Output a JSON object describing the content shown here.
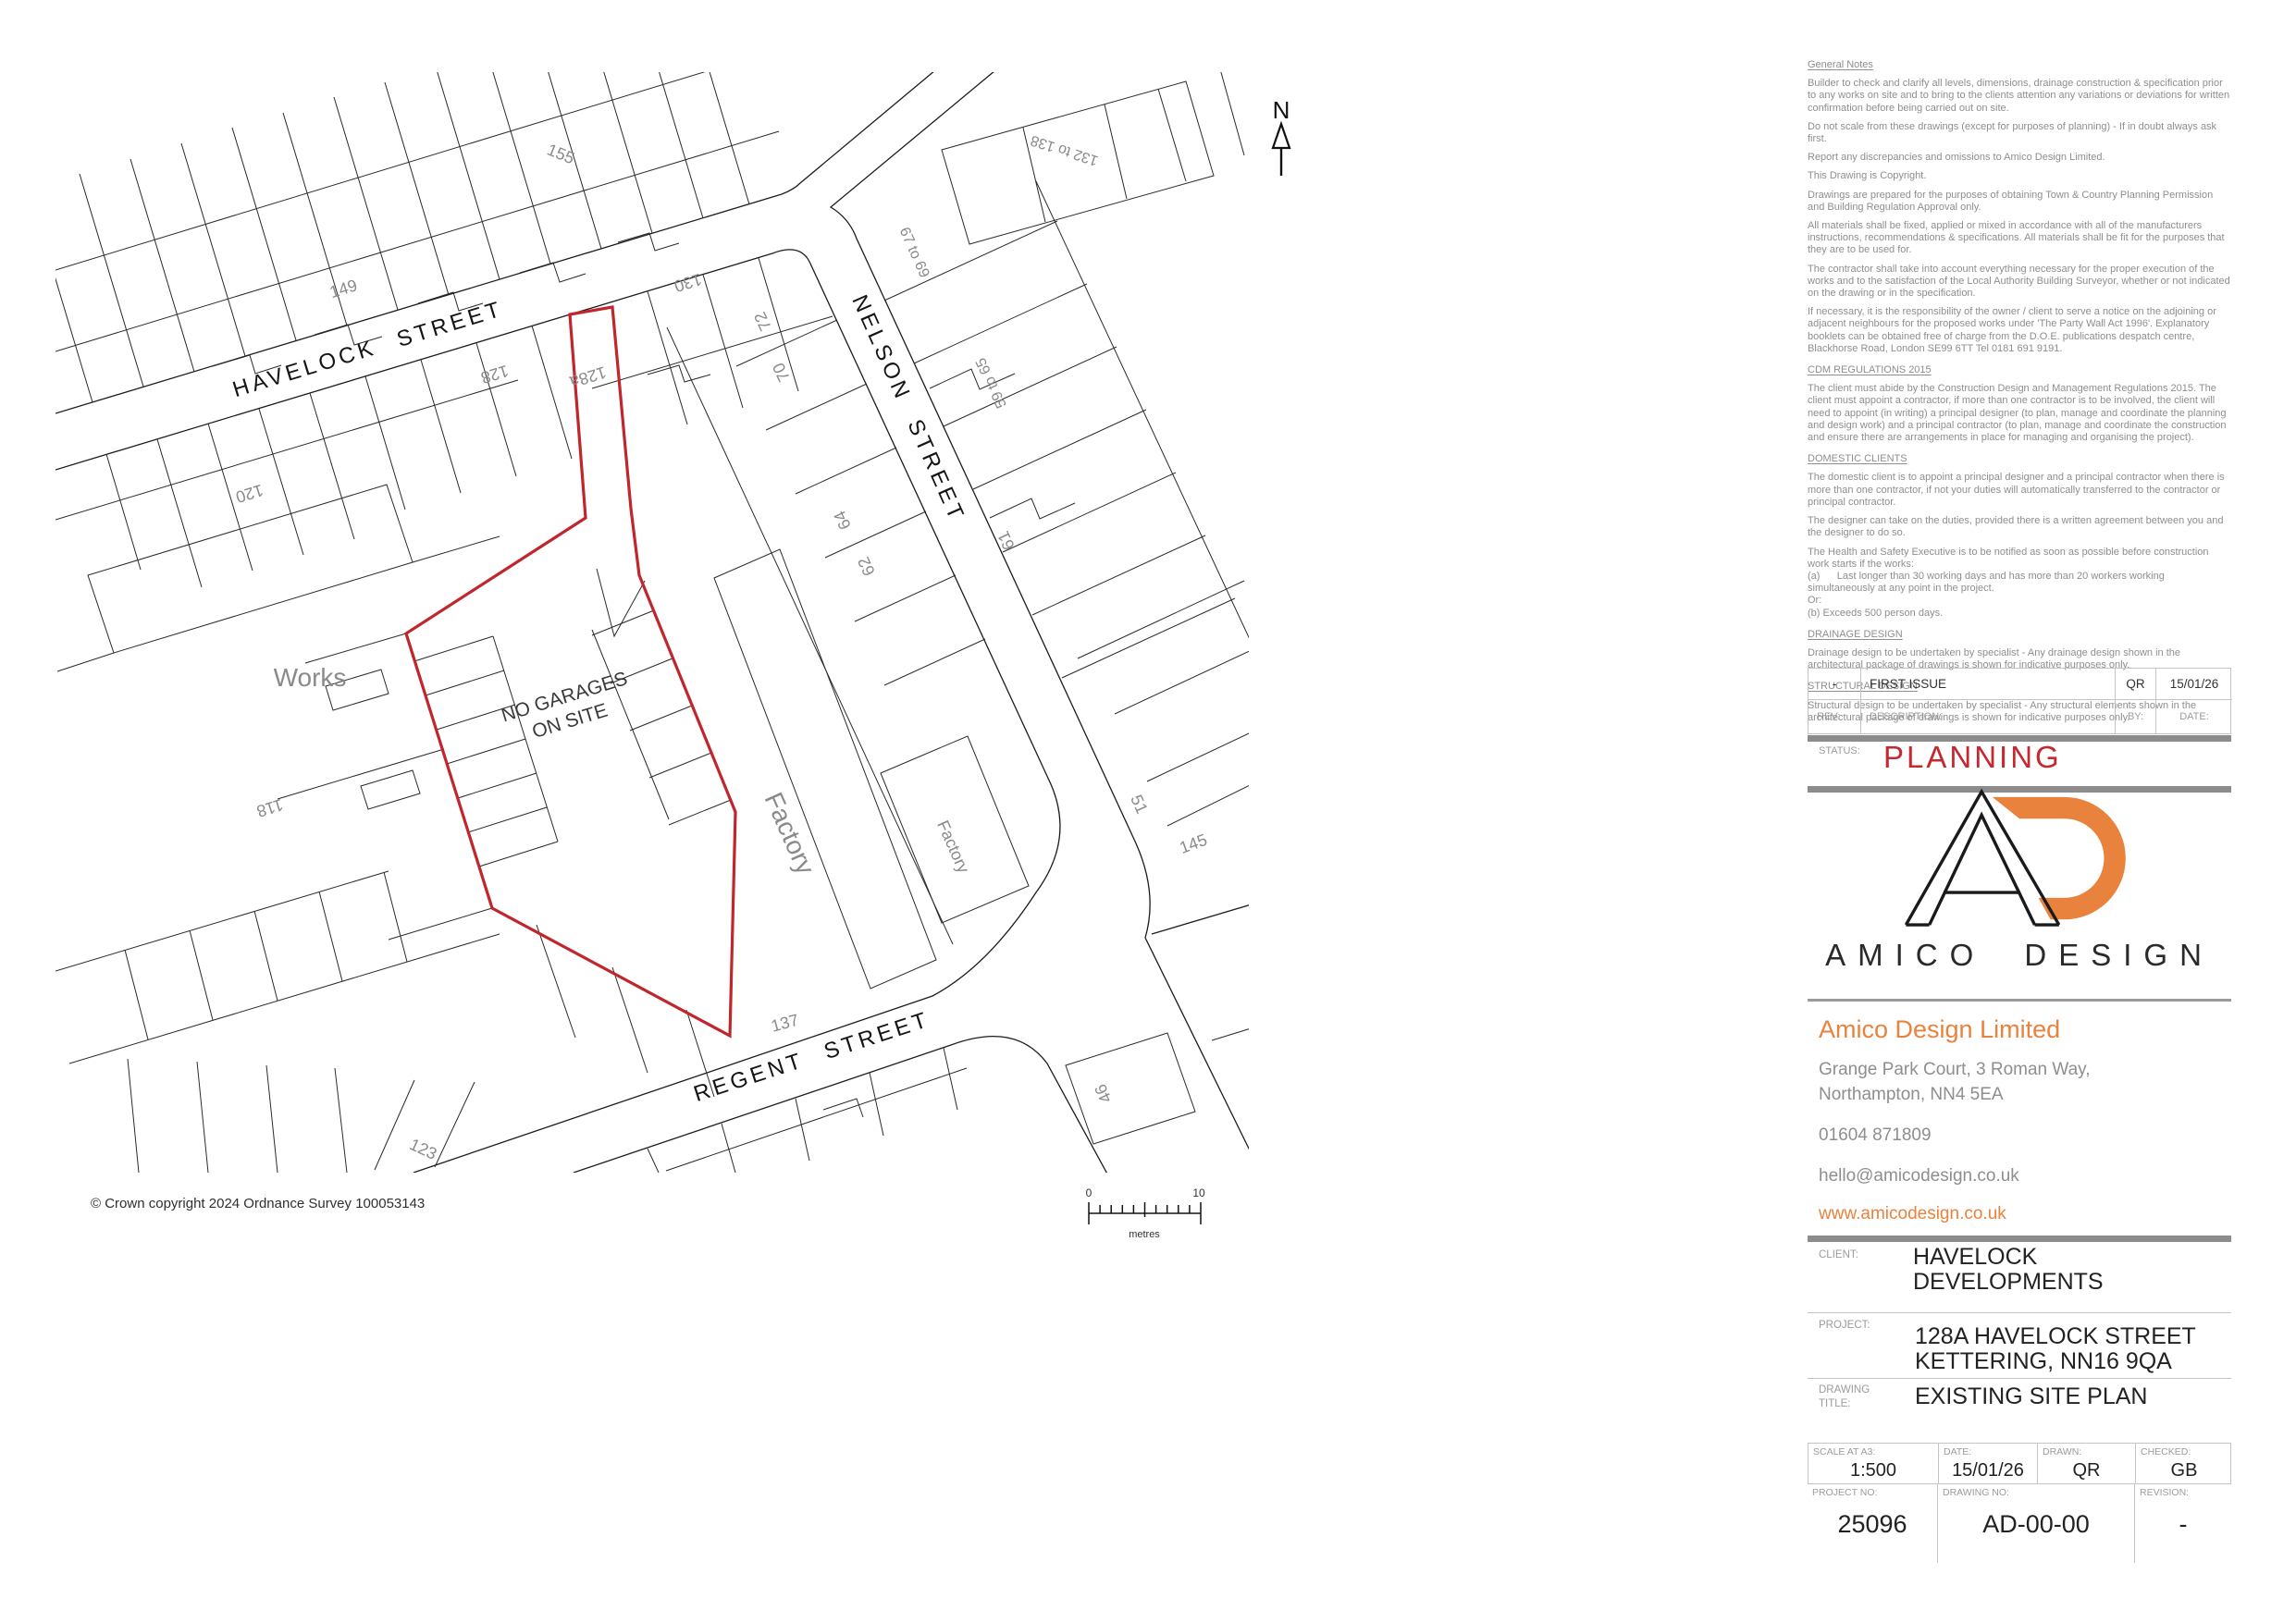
{
  "map": {
    "streets": {
      "havelock": "HAVELOCK STREET",
      "nelson": "NELSON STREET",
      "regent": "REGENT STREET"
    },
    "labels": {
      "works": "Works",
      "factory_large": "Factory",
      "factory_small": "Factory",
      "no_garages_line1": "NO GARAGES",
      "no_garages_line2": "ON SITE",
      "n149": "149",
      "n155": "155",
      "n120": "120",
      "n130": "130",
      "n128": "128",
      "n128a": "128a",
      "n118": "118",
      "n72": "72",
      "n70": "70",
      "n64": "64",
      "n62": "62",
      "n67_69": "67 to 69",
      "n132_138": "132 to 138",
      "n59_65": "59 to 65",
      "n61": "61",
      "n51": "51",
      "n145": "145",
      "n137": "137",
      "n123": "123",
      "n46": "46"
    },
    "north": "N",
    "scale_bar": {
      "start": "0",
      "end": "10",
      "unit": "metres"
    },
    "copyright": "© Crown copyright 2024 Ordnance Survey 100053143"
  },
  "notes": {
    "general": {
      "heading": "General Notes",
      "paragraphs": [
        "Builder to check and clarify all levels, dimensions, drainage construction & specification prior to any works on site and to bring to the clients attention any variations or deviations for written confirmation before being carried out on site.",
        "Do not scale from these drawings (except for purposes of planning) - If in doubt always ask first.",
        "Report any discrepancies and omissions to Amico Design Limited.",
        "This Drawing is Copyright.",
        "Drawings are prepared for the purposes of obtaining Town & Country Planning Permission and Building Regulation Approval only.",
        "All materials shall be fixed, applied or mixed in accordance with all of the manufacturers instructions, recommendations & specifications. All materials shall be fit for the purposes that they are to be used for.",
        "The contractor shall take into account everything necessary for the proper execution of the works and to the satisfaction of the Local Authority Building Surveyor, whether or not indicated on the drawing or in the specification.",
        "If necessary, it is the responsibility of the owner / client to serve a notice on the adjoining or adjacent neighbours for the proposed works under 'The Party Wall Act 1996'. Explanatory booklets can be obtained free of charge from the D.O.E. publications despatch centre, Blackhorse Road, London SE99 6TT Tel 0181 691 9191."
      ]
    },
    "cdm": {
      "heading": "CDM REGULATIONS 2015",
      "paragraphs": [
        "The client must abide by the Construction Design and Management Regulations 2015. The client must appoint a contractor, if more than one contractor is to be involved, the client will need to appoint (in writing) a principal designer (to plan, manage and coordinate the planning and design work) and a principal contractor (to plan, manage and coordinate the construction and ensure there are arrangements in place for managing and organising the project)."
      ]
    },
    "domestic": {
      "heading": "DOMESTIC CLIENTS",
      "paragraphs": [
        "The domestic client is to appoint a principal designer and a principal contractor when there is more than one contractor, if not your duties will automatically transferred to the contractor or principal contractor.",
        "The designer can take on the duties, provided there is a written agreement between you and the designer to do so.",
        "The Health and Safety Executive is to be notified as soon as possible before construction work starts if the works:\n(a)      Last longer than 30 working days and has more than 20 workers working simultaneously at any point in the project.\nOr:\n(b) Exceeds 500 person days."
      ]
    },
    "drainage": {
      "heading": "DRAINAGE DESIGN",
      "paragraphs": [
        "Drainage design to be undertaken by specialist - Any drainage design shown in the architectural package of drawings is shown for indicative purposes only."
      ]
    },
    "structural": {
      "heading": "STRUCTURAL DESIGN",
      "paragraphs": [
        "Structural design to be undertaken by specialist - Any structural elements shown in the architectural package of drawings is shown for indicative purposes only."
      ]
    }
  },
  "revision_table": {
    "row": {
      "rev": "-",
      "description": "FIRST ISSUE",
      "by": "QR",
      "date": "15/01/26"
    },
    "headers": {
      "rev": "REV:",
      "description": "DESCRIPTION:",
      "by": "BY:",
      "date": "DATE:"
    }
  },
  "status": {
    "label": "STATUS:",
    "value": "PLANNING"
  },
  "brand": {
    "logo_text": "AMICO DESIGN",
    "company": "Amico Design Limited",
    "address_line1": "Grange Park Court, 3 Roman Way,",
    "address_line2": "Northampton, NN4 5EA",
    "phone": "01604 871809",
    "email": "hello@amicodesign.co.uk",
    "website": "www.amicodesign.co.uk"
  },
  "client": {
    "label": "CLIENT:",
    "value": "HAVELOCK DEVELOPMENTS"
  },
  "project": {
    "label": "PROJECT:",
    "line1": "128A HAVELOCK STREET",
    "line2": "KETTERING, NN16 9QA"
  },
  "drawing_title": {
    "label_line1": "DRAWING",
    "label_line2": "TITLE:",
    "value": "EXISTING SITE PLAN"
  },
  "info_grid": {
    "scale": {
      "label": "SCALE AT A3:",
      "value": "1:500"
    },
    "date": {
      "label": "DATE:",
      "value": "15/01/26"
    },
    "drawn": {
      "label": "DRAWN:",
      "value": "QR"
    },
    "checked": {
      "label": "CHECKED:",
      "value": "GB"
    },
    "project_no": {
      "label": "PROJECT NO:",
      "value": "25096"
    },
    "drawing_no": {
      "label": "DRAWING NO:",
      "value": "AD-00-00"
    },
    "revision": {
      "label": "REVISION:",
      "value": "-"
    }
  },
  "colors": {
    "accent_orange": "#e8823c",
    "status_red": "#c5282f",
    "boundary_red": "#c0262c",
    "divider_gray": "#8c8c8c",
    "note_gray": "#8e8e8e"
  }
}
